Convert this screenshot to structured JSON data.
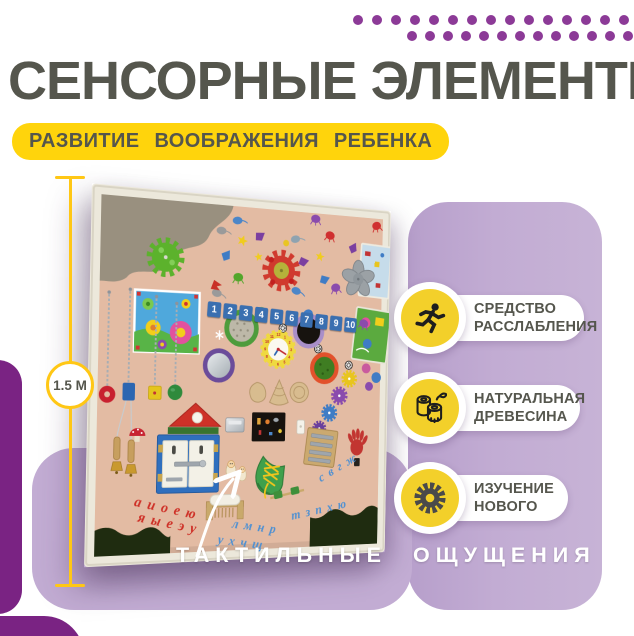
{
  "header": {
    "title": "СЕНСОРНЫЕ ЭЛЕМЕНТЫ",
    "subtitle": "РАЗВИТИЕ ВООБРАЖЕНИЯ РЕБЕНКА"
  },
  "ruler": {
    "label": "1.5 М"
  },
  "decor": {
    "dots_row1": 15,
    "dots_row2": 13
  },
  "badges": {
    "relax": {
      "line1": "СРЕДСТВО",
      "line2": "РАССЛАБЛЕНИЯ"
    },
    "wood": {
      "line1": "НАТУРАЛЬНАЯ",
      "line2": "ДРЕВЕСИНА"
    },
    "learn": {
      "line1": "ИЗУЧЕНИЕ",
      "line2": "НОВОГО"
    }
  },
  "caption": "ТАКТИЛЬНЫЕ ОЩУЩЕНИЯ",
  "board": {
    "numbers": [
      "1",
      "2",
      "3",
      "4",
      "5",
      "6",
      "7",
      "8",
      "9",
      "10"
    ],
    "clock_numbers": [
      "12",
      "1",
      "2",
      "3",
      "4",
      "5",
      "6",
      "7",
      "8",
      "9",
      "10",
      "11"
    ],
    "letters": {
      "red_row1": "а и о е ю",
      "red_row2": "я ы е э у",
      "blue_row1": "л м н р",
      "blue_row2": "у х ч щ",
      "blue_right1": "с в г ж",
      "blue_right2": "т з п х ю"
    }
  },
  "colors": {
    "accent_yellow": "#FFD40C",
    "badge_yellow": "#F3D02A",
    "title_gray": "#55564D",
    "dot_purple": "#8C3A97",
    "purple_dark": "#7A2383",
    "lavender": "#C2ACD3",
    "board_beige": "#E3BBA3",
    "caption_white": "#FFFFFF"
  }
}
